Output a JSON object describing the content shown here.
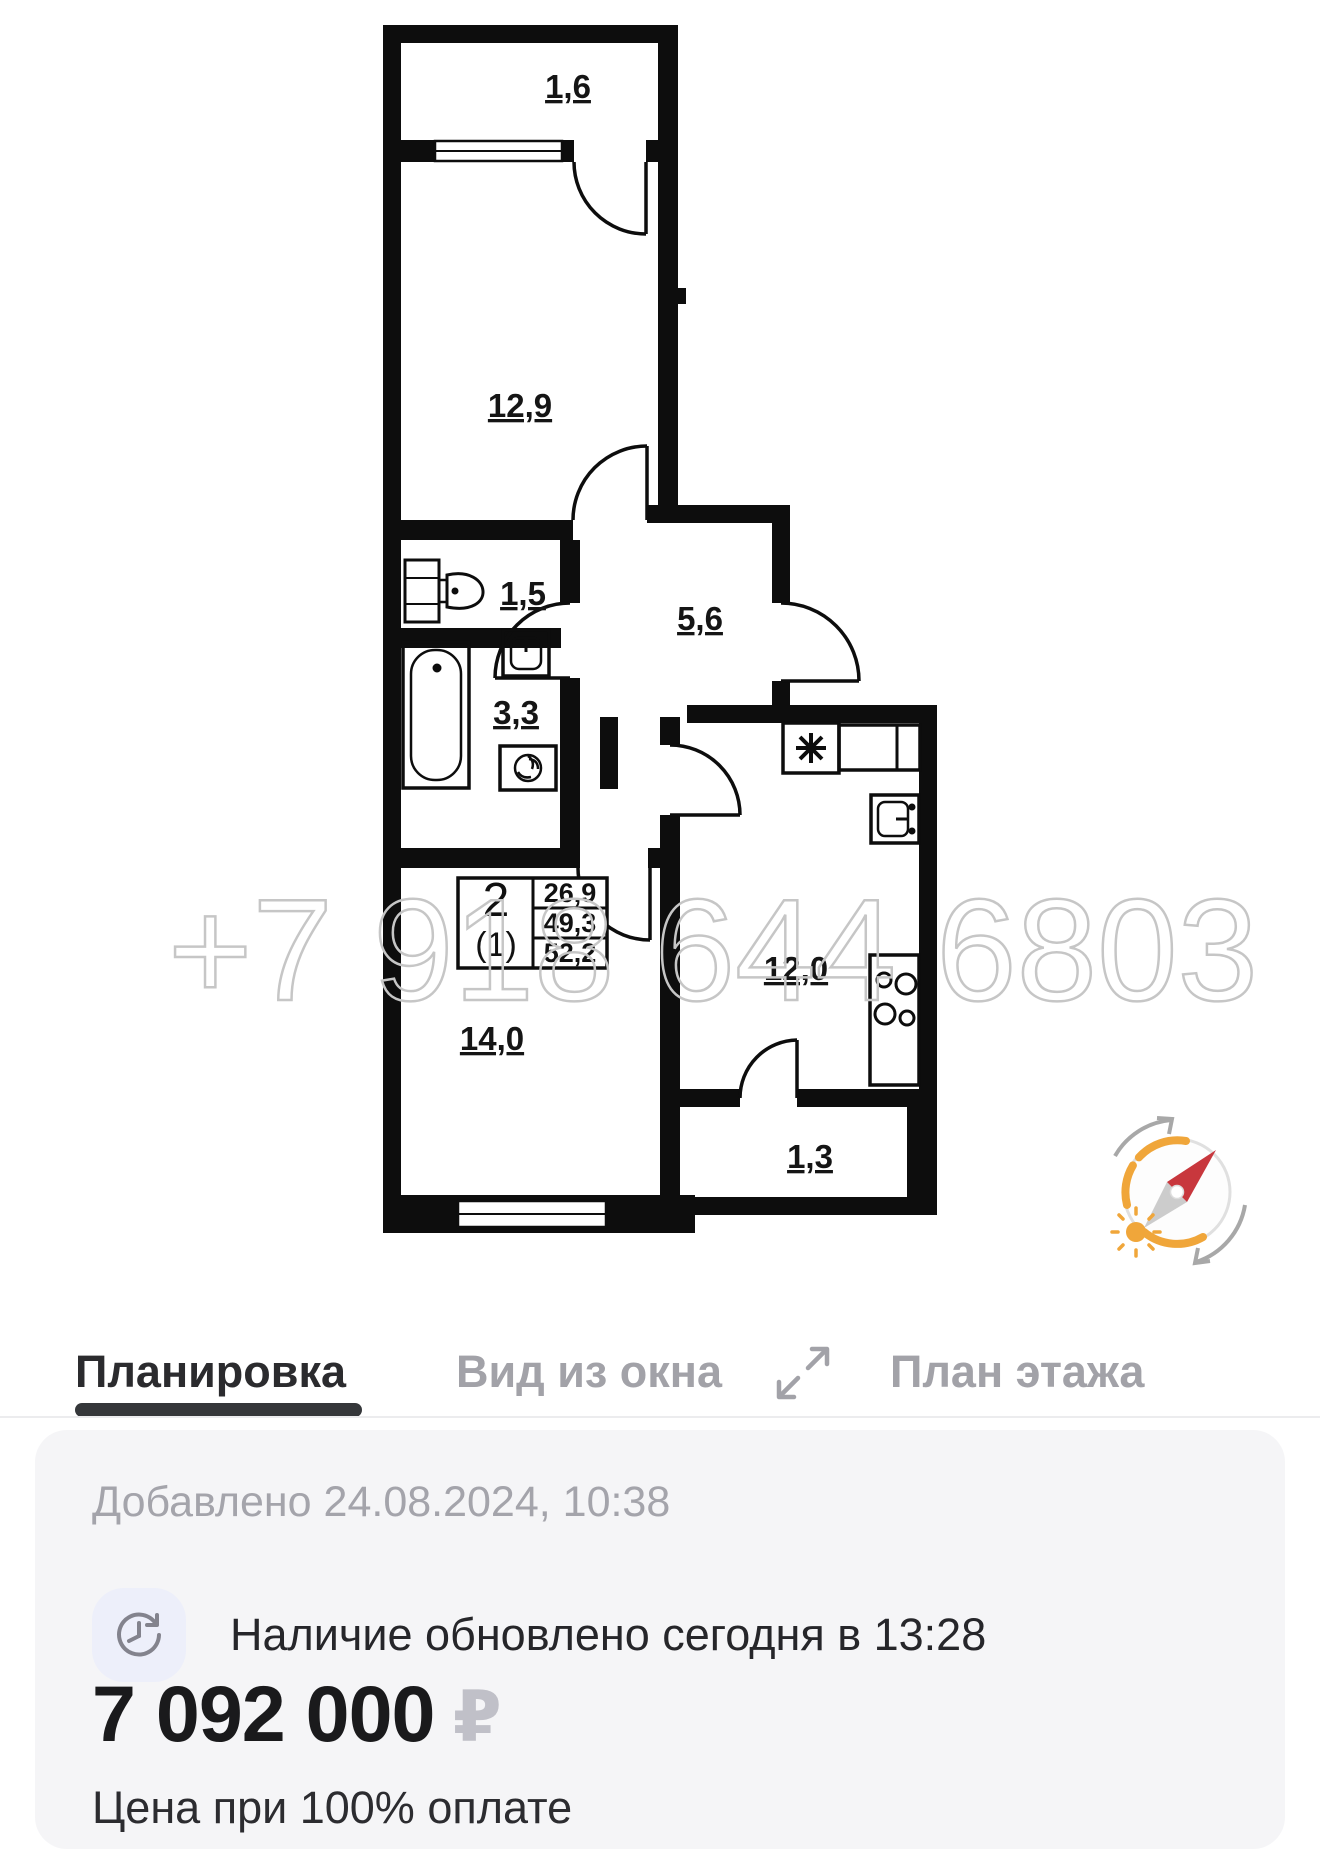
{
  "floorplan": {
    "watermark": "+7 918 644 6803",
    "rooms": [
      {
        "name": "loggia-top",
        "area": "1,6"
      },
      {
        "name": "room-12-9",
        "area": "12,9"
      },
      {
        "name": "wc",
        "area": "1,5"
      },
      {
        "name": "hallway",
        "area": "5,6"
      },
      {
        "name": "bathroom",
        "area": "3,3"
      },
      {
        "name": "room-14-0",
        "area": "14,0"
      },
      {
        "name": "kitchen",
        "area": "12,0"
      },
      {
        "name": "loggia-bottom",
        "area": "1,3"
      }
    ],
    "info_table": {
      "rooms_count": "2",
      "unit": "(1)",
      "living_area": "26,9",
      "area_without_summer": "49,3",
      "total_area": "52,2"
    }
  },
  "tabs": [
    {
      "label": "Планировка",
      "active": true
    },
    {
      "label": "Вид из окна",
      "active": false
    },
    {
      "label": "План этажа",
      "active": false
    }
  ],
  "details": {
    "added": "Добавлено 24.08.2024, 10:38",
    "availability": "Наличие обновлено сегодня в 13:28",
    "price_amount": "7 092 000",
    "price_currency": "₽",
    "price_note": "Цена при 100% оплате"
  },
  "colors": {
    "accent_orange": "#f0a63a",
    "needle_red": "#c8373d",
    "watermark_gray": "#c6c6c6",
    "card_bg": "#f5f5f7",
    "tab_active": "#2b2b2e",
    "tab_inactive": "#a2a2a8"
  }
}
